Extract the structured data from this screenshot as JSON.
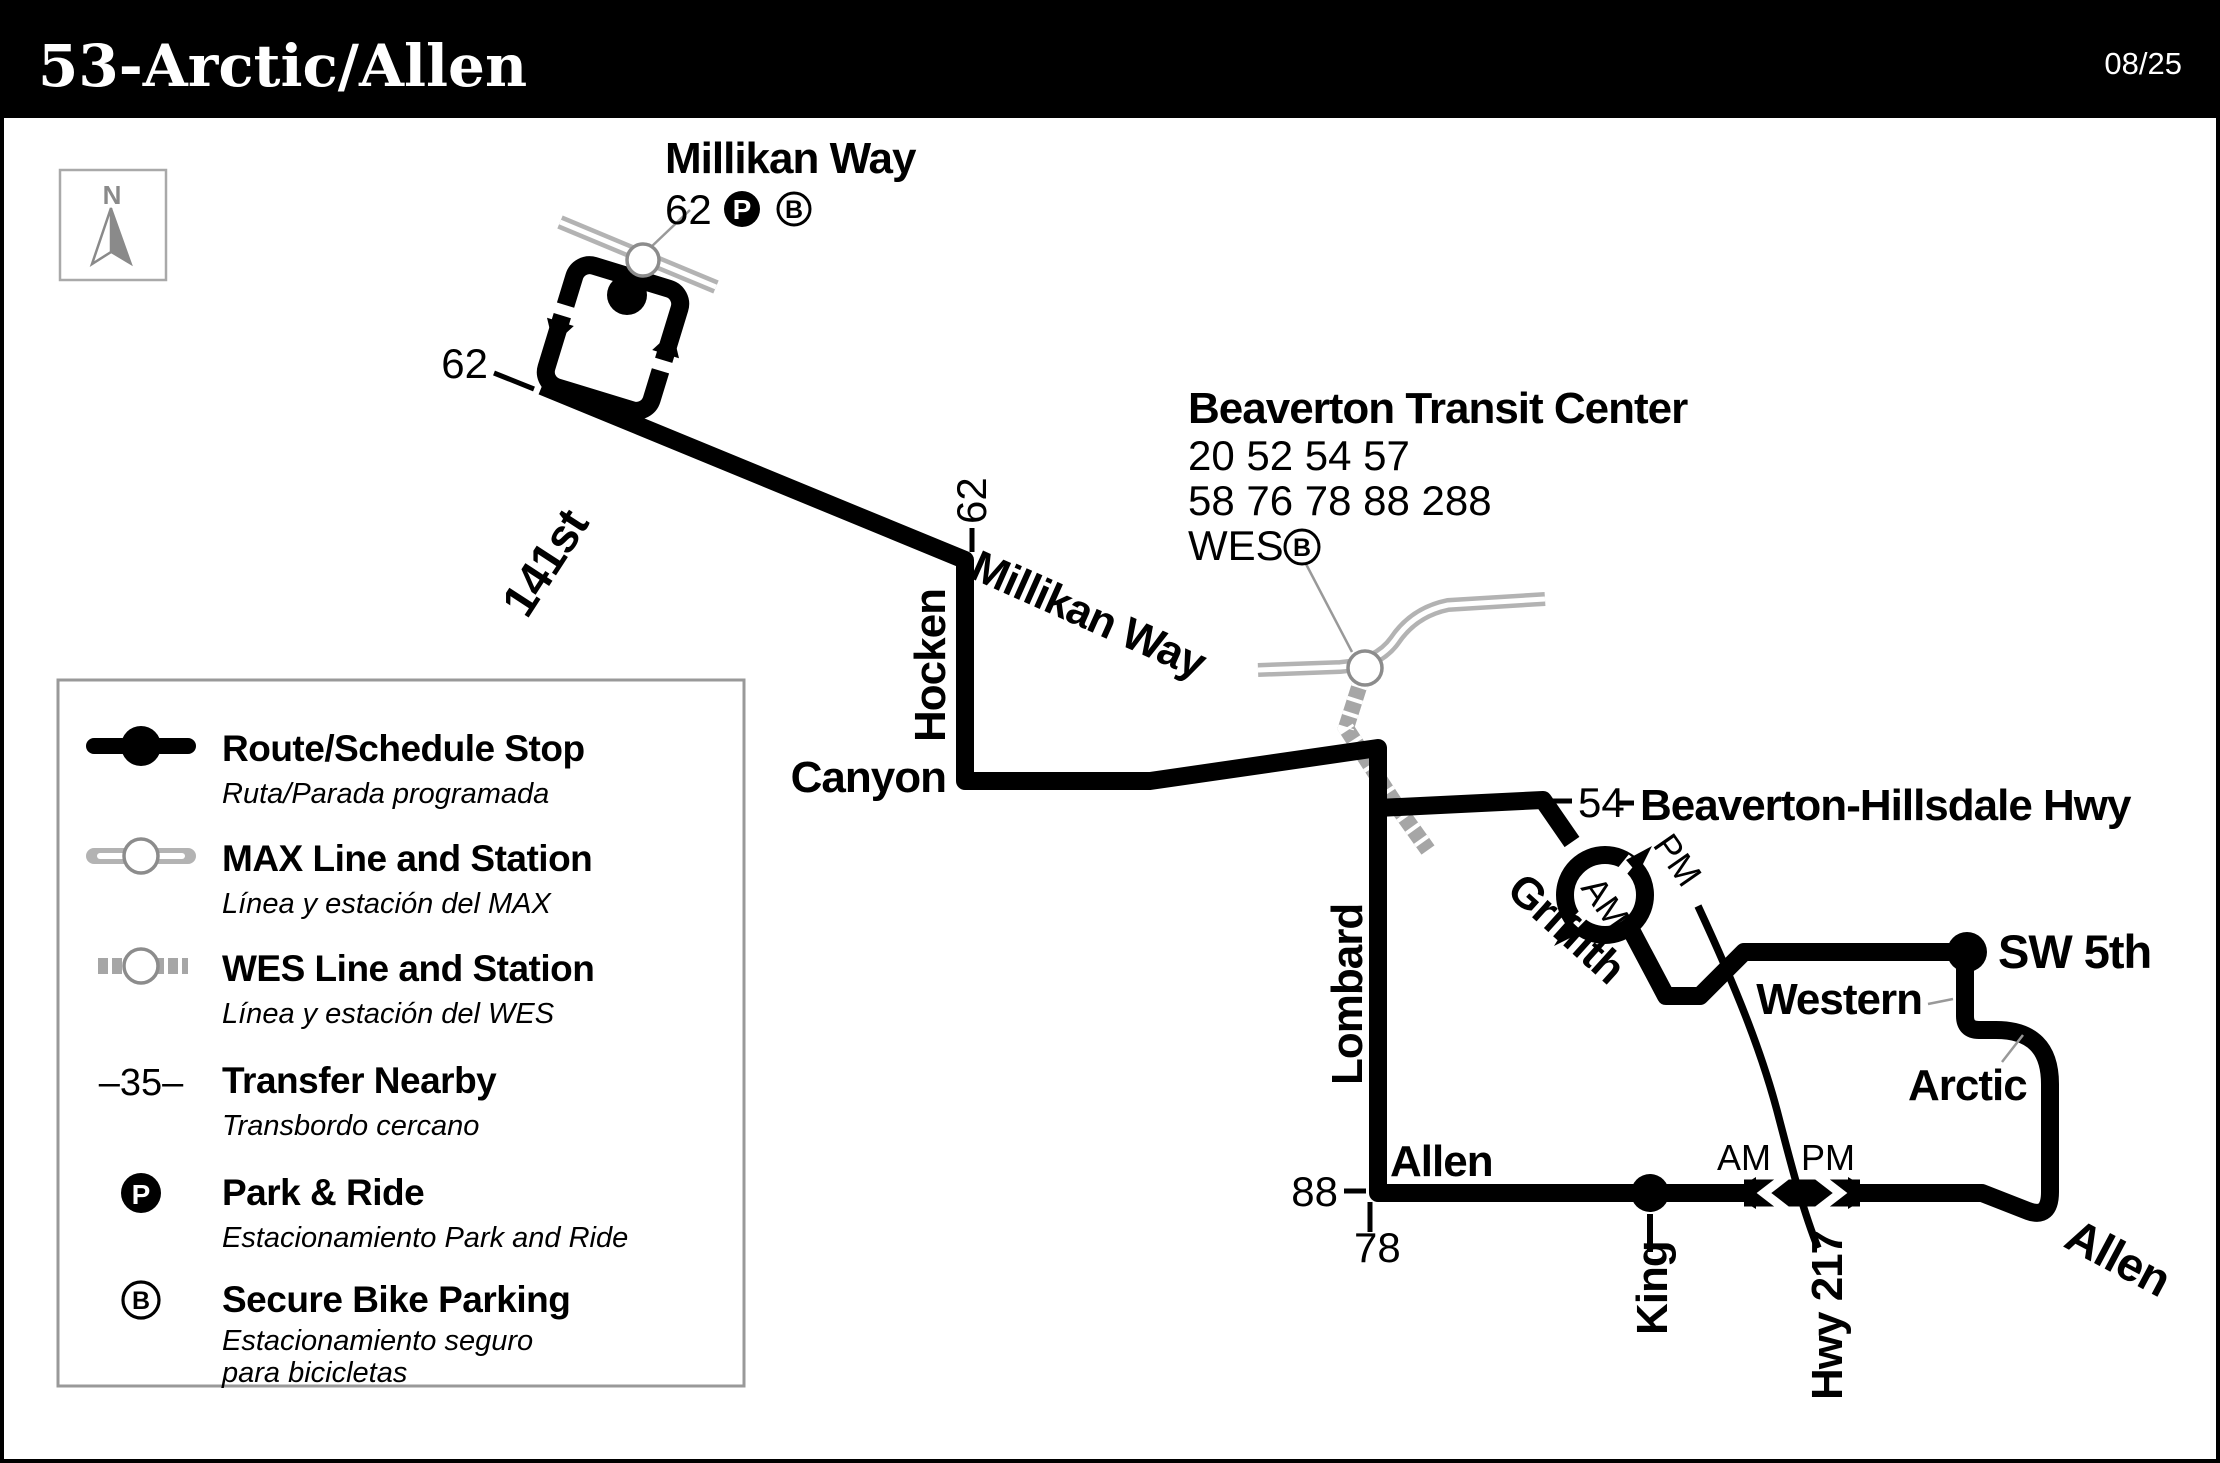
{
  "header": {
    "title": "53-Arctic/Allen",
    "date": "08/25"
  },
  "compass": {
    "north": "N"
  },
  "legend": {
    "items": [
      {
        "label": "Route/Schedule Stop",
        "sublabel": "Ruta/Parada programada"
      },
      {
        "label": "MAX Line and Station",
        "sublabel": "Línea y estación del MAX"
      },
      {
        "label": "WES Line and Station",
        "sublabel": "Línea y estación del WES"
      },
      {
        "icon_text": "–35–",
        "label": "Transfer Nearby",
        "sublabel": "Transbordo cercano"
      },
      {
        "icon_text": "P",
        "label": "Park & Ride",
        "sublabel": "Estacionamiento Park and Ride"
      },
      {
        "icon_text": "B",
        "label": "Secure Bike Parking",
        "sublabel": "Estacionamiento seguro",
        "sublabel2": "para bicicletas"
      }
    ]
  },
  "map": {
    "millikan_station": {
      "name": "Millikan Way",
      "routes": "62",
      "park_ride_badge": "P",
      "bike_badge": "B"
    },
    "transit_center": {
      "name": "Beaverton Transit Center",
      "routes_line1": "20 52 54 57",
      "routes_line2": "58 76 78 88 288",
      "routes_line3": "WES",
      "bike_badge": "B"
    },
    "streets": {
      "millikan_way": "Millikan Way",
      "st_141": "141st",
      "hocken": "Hocken",
      "canyon": "Canyon",
      "lombard": "Lombard",
      "griffith": "Griffith",
      "beaverton_hillsdale_hwy": "Beaverton-Hillsdale Hwy",
      "sw_5th": "SW 5th",
      "western": "Western",
      "arctic": "Arctic",
      "allen": "Allen",
      "allen_east": "Allen",
      "king": "King",
      "hwy_217": "Hwy 217"
    },
    "transfers": {
      "millikan_62": "62",
      "hocken_62": "62",
      "bh_54": "54",
      "allen_88": "88",
      "allen_78": "78"
    },
    "directions": {
      "loop_am": "AM",
      "loop_pm": "PM",
      "allen_am": "AM",
      "allen_pm": "PM"
    }
  }
}
